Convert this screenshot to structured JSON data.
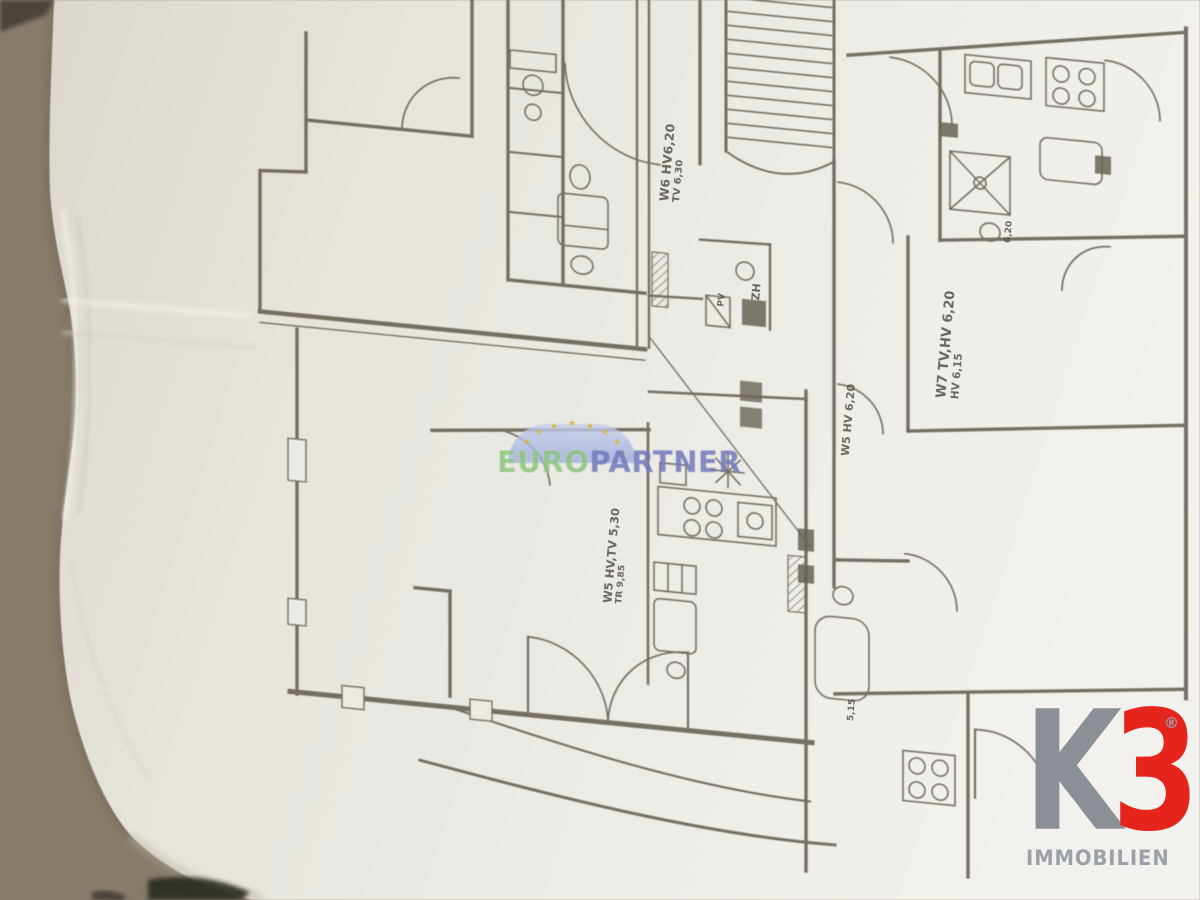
{
  "photo": {
    "subject": "apartment-building-floor-plan-on-paper"
  },
  "watermark": {
    "prefix": "EURO",
    "suffix": "PARTNER",
    "star": "★",
    "colors": {
      "prefix": "#8cc57e",
      "suffix": "#7278bb",
      "arc": "#a9b8e6",
      "star": "#d8b93a"
    }
  },
  "agency_logo": {
    "k": "K",
    "three": "3",
    "registered": "®",
    "subtitle": "IMMOBILIEN",
    "colors": {
      "k": "#8b9096",
      "three": "#e5241b",
      "subtitle": "#9aa1a8"
    }
  },
  "plan_labels": {
    "w6": {
      "line1": "W6 HV6,20",
      "line2": "TV 6,30"
    },
    "w7": {
      "line1": "W7 TV,HV 6,20",
      "line2": "HV 6,15"
    },
    "w5_right": {
      "line1": "W5 HV 6,20"
    },
    "w5_left": {
      "line1": "W5 HV,TV 5,30",
      "line2": "TR 9,85"
    },
    "zh": "ZH",
    "pv": "PV",
    "dim_620": "6,20",
    "dim_515": "5,15"
  }
}
